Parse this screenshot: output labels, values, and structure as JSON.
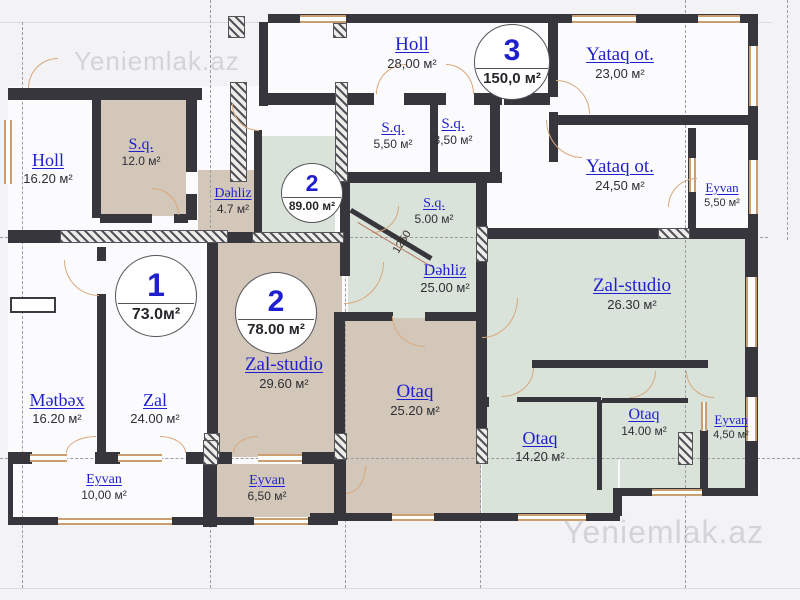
{
  "watermark": "Yeniemlak.az",
  "apartments": [
    {
      "number": "1",
      "area": "73.0м²"
    },
    {
      "number": "2",
      "area": "78.00 м²"
    },
    {
      "number": "2",
      "area": "89.00 м²"
    },
    {
      "number": "3",
      "area": "150,0 м²"
    }
  ],
  "rooms": [
    {
      "name": "Holl",
      "area": "16.20 м²"
    },
    {
      "name": "S.q.",
      "area": "12.0 м²"
    },
    {
      "name": "Dəhliz",
      "area": "4.7 м²"
    },
    {
      "name": "Holl",
      "area": "28,00 м²"
    },
    {
      "name": "Yataq ot.",
      "area": "23,00 м²"
    },
    {
      "name": "S.q.",
      "area": "5,50 м²"
    },
    {
      "name": "S.q.",
      "area": "3,50 м²"
    },
    {
      "name": "Yataq ot.",
      "area": "24,50 м²"
    },
    {
      "name": "Eyvan",
      "area": "5,50 м²"
    },
    {
      "name": "S.q.",
      "area": "5.00 м²"
    },
    {
      "name": "Dəhliz",
      "area": "25.00 м²"
    },
    {
      "name": "Mətbəx",
      "area": "16.20 м²"
    },
    {
      "name": "Zal",
      "area": "24.00 м²"
    },
    {
      "name": "Zal-studio",
      "area": "29.60 м²"
    },
    {
      "name": "Otaq",
      "area": "25.20 м²"
    },
    {
      "name": "Zal-studio",
      "area": "26.30 м²"
    },
    {
      "name": "Otaq",
      "area": "14.20 м²"
    },
    {
      "name": "Otaq",
      "area": "14.00 м²"
    },
    {
      "name": "Eyvan",
      "area": "4,50 м²"
    },
    {
      "name": "Eyvan",
      "area": "10,00 м²"
    },
    {
      "name": "Eyvan",
      "area": "6,50 м²"
    }
  ],
  "dimension_label": "1250",
  "colors": {
    "wall": "#37363c",
    "apartment_beige": "#d2c7b9",
    "apartment_green": "#d9e3da",
    "label_blue": "#1f1fd0",
    "window_tan": "#c99f72",
    "door_arc_tan": "#d8a87c"
  }
}
